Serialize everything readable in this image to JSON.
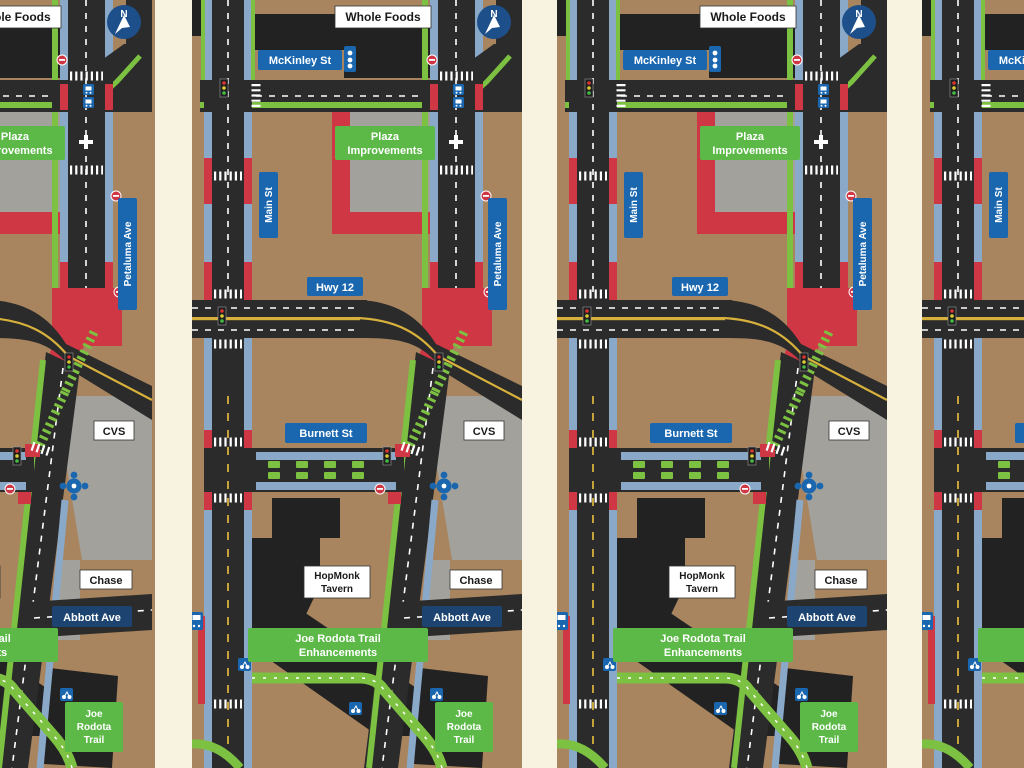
{
  "view": {
    "panel_count": 4,
    "description_note": ""
  },
  "map": {
    "labels": {
      "whole_foods": "Whole Foods",
      "mckinley_st": "McKinley St",
      "plaza_line1": "Plaza",
      "plaza_line2": "Improvements",
      "petaluma_ave": "Petaluma Ave",
      "main_st": "Main St",
      "hwy_12": "Hwy 12",
      "burnett_st": "Burnett St",
      "cvs": "CVS",
      "hopmonk_line1": "HopMonk",
      "hopmonk_line2": "Tavern",
      "chase": "Chase",
      "abbott_ave": "Abbott Ave",
      "trail_enh_line1": "Joe Rodota Trail",
      "trail_enh_line2": "Enhancements",
      "trail_line1": "Joe",
      "trail_line2": "Rodota",
      "trail_line3": "Trail",
      "compass_n": "N"
    },
    "colors": {
      "canvas_cream": "#f8f2e1",
      "ground_tan": "#a8855f",
      "road_dark": "#2b2b2b",
      "building_dark": "#222222",
      "plaza_gray": "#a2a19c",
      "curb_red": "#cf3744",
      "bike_green": "#7cc142",
      "parking_blue": "#8aa9c9",
      "label_blue": "#1a67b0",
      "label_green": "#5cb948",
      "label_navy": "#1d4470",
      "compass_blue": "#1d4f8a",
      "centerline_yellow": "#d8b13c",
      "label_white": "#ffffff"
    }
  }
}
